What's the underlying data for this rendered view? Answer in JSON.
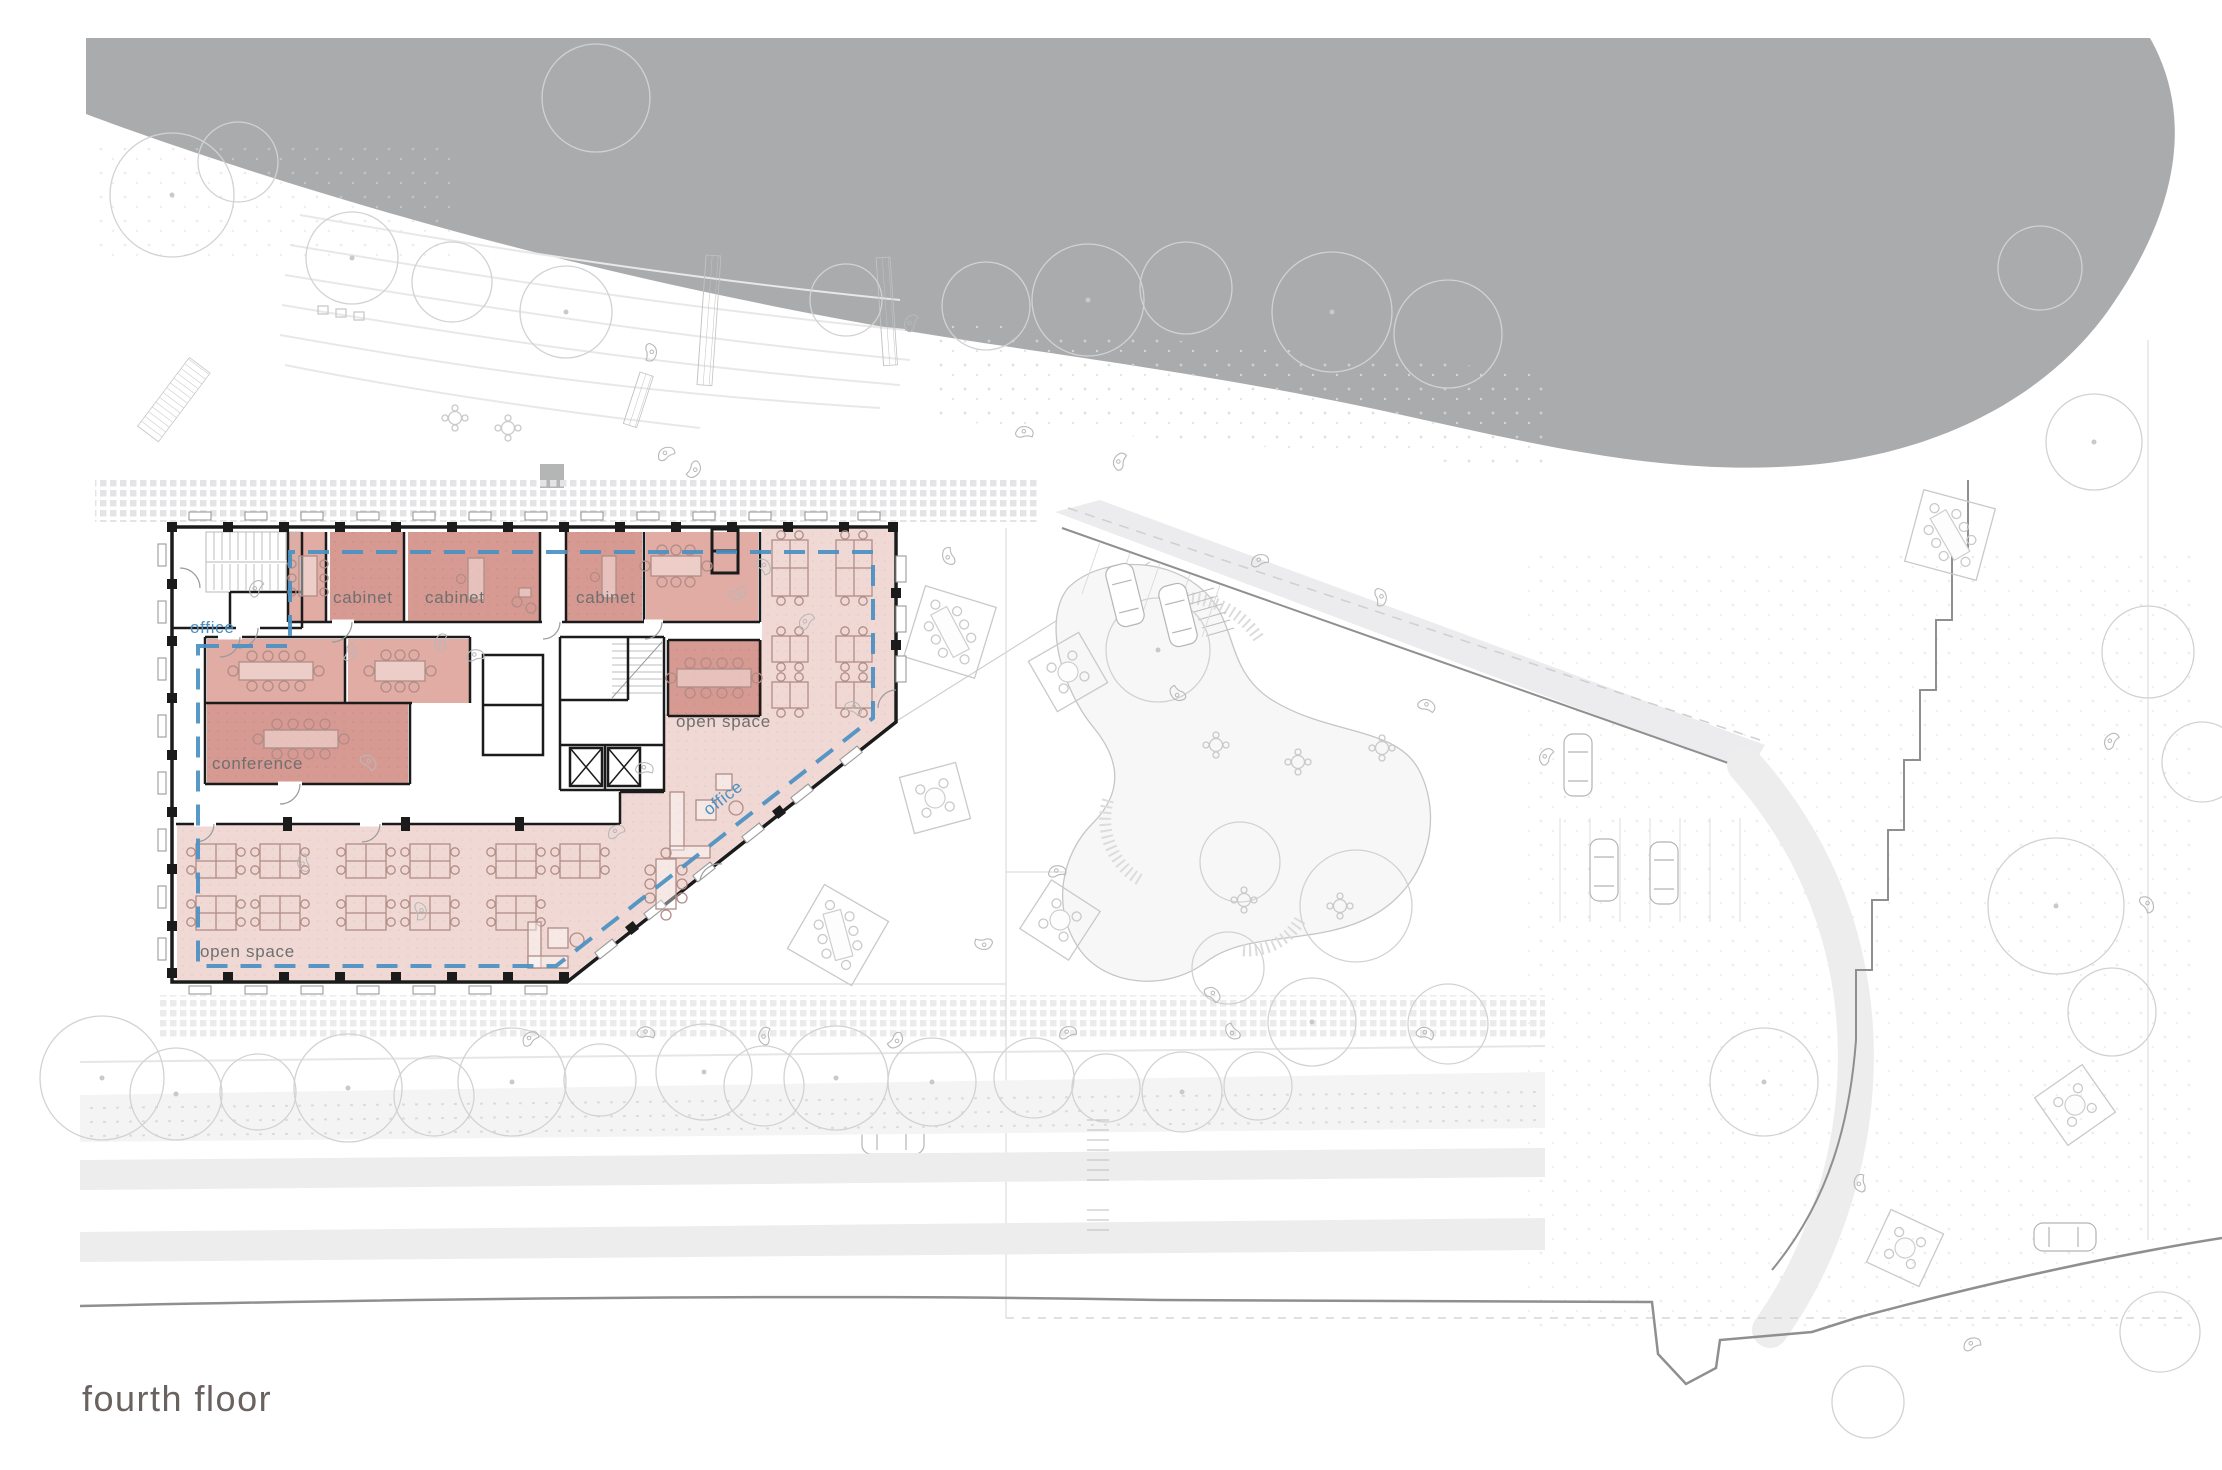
{
  "title": {
    "text": "fourth floor"
  },
  "plan": {
    "room_labels": {
      "cabinet_1": "cabinet",
      "cabinet_2": "cabinet",
      "cabinet_3": "cabinet",
      "conference": "conference",
      "open_space_upper": "open space",
      "open_space_lower": "open space"
    },
    "zone_labels": {
      "office_left": "office",
      "office_diagonal": "office"
    }
  },
  "colors": {
    "water": "#a9abad",
    "room_dark": "#d79a92",
    "room_mid": "#e0aca4",
    "room_light": "#f0d9d4",
    "accent_blue": "#4a90c2",
    "wall": "#1b1b1b",
    "label": "#6f6f6f",
    "title": "#6a625f"
  }
}
